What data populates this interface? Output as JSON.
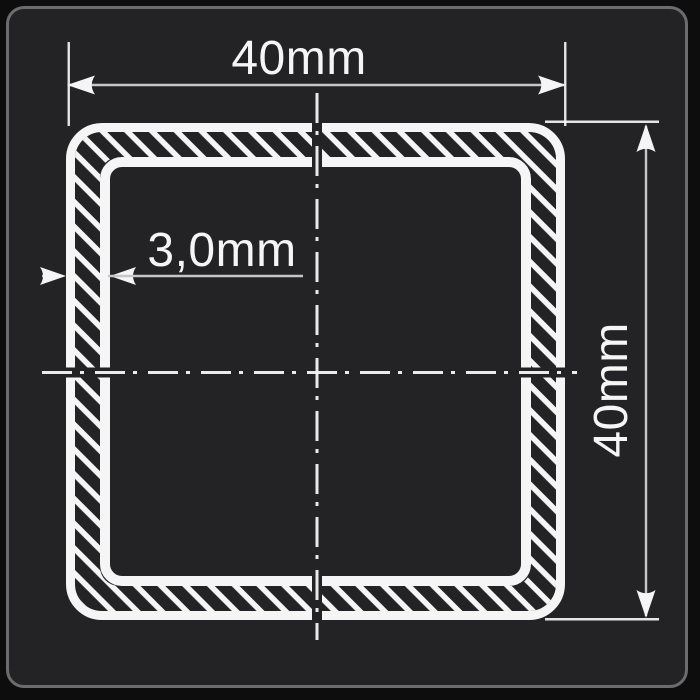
{
  "drawing": {
    "type": "square-tube-cross-section",
    "description": "Cross-section of a square hollow tube, 40mm x 40mm outer size with 3.0mm wall thickness, white lines on dark background",
    "labels": {
      "width": "40mm",
      "height": "40mm",
      "thickness": "3,0mm"
    },
    "colors": {
      "page_background": "#0d0d0d",
      "card_background": "#232325",
      "card_border": "#6c6c6c",
      "drawing_line": "#f5f5f5",
      "dimension_line": "#c6c6c6"
    }
  }
}
